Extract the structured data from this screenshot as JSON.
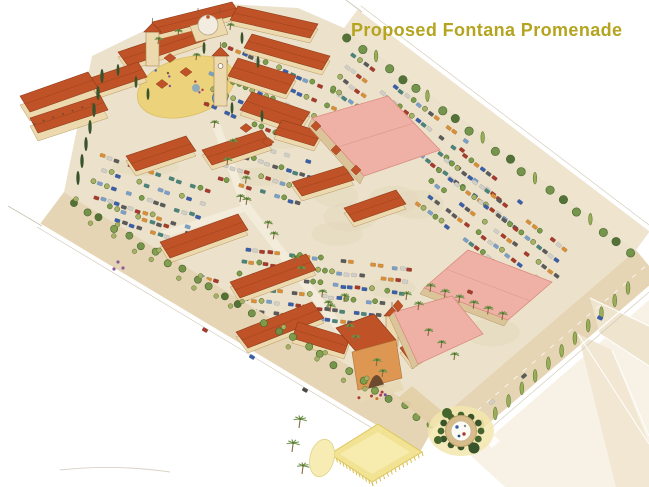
{
  "title": {
    "text": "Proposed Fontana Promenade",
    "color": "#b5a41f"
  },
  "background": "#ffffff",
  "palette": {
    "ground": "#ece2cb",
    "groundLight": "#f3ecdb",
    "road": "#e6d5b5",
    "roadPale": "#efe5cf",
    "cornerWash": "#f5eedd",
    "roofRed": "#bf5226",
    "roofRedDark": "#8f3c1c",
    "roofPink": "#efb0a5",
    "roofPinkDark": "#d98d80",
    "wallCream": "#ecd9ae",
    "wallShade": "#dcc49a",
    "wallOrange": "#dd9752",
    "treeGreen": "#7d9c4a",
    "treeOlive": "#a8b065",
    "treeDark": "#46652e",
    "cypress": "#39532c",
    "palmGreen": "#6f934c",
    "plazaYellow": "#ecd27a",
    "fieldYellow": "#f2e394",
    "fountainBlue": "#78a3c8",
    "carColors": [
      "#3a5fa8",
      "#a63b2c",
      "#49837a",
      "#d1cfc8",
      "#d98f35",
      "#5a5a5a",
      "#7aa0c8"
    ]
  },
  "scene": {
    "type": "watercolor-aerial-site-plan",
    "features": [
      "mediterranean village cluster",
      "clock tower",
      "domed pavilion",
      "plaza fountain",
      "pink-roof anchor stores",
      "red-tile shop strips",
      "parking lots with cars",
      "palm-lined main street",
      "perimeter street trees",
      "corner roundabout fountain",
      "yellow lawn panel",
      "boundary roads"
    ]
  }
}
